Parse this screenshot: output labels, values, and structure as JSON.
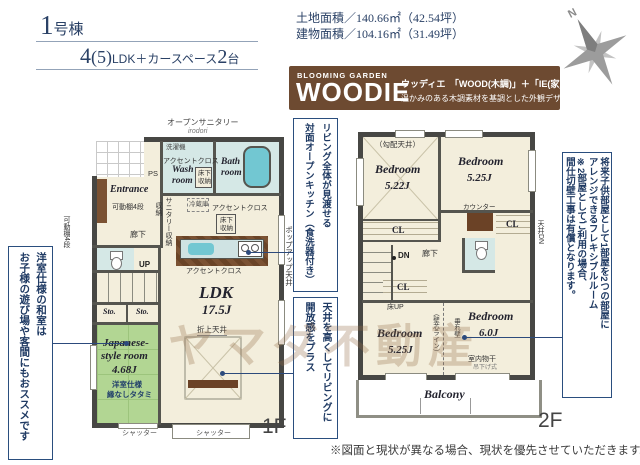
{
  "header": {
    "building_num": "1",
    "building_suffix": "号棟",
    "plan_main": "4",
    "plan_paren": "(5)",
    "plan_mid": "LDK＋カースペース",
    "plan_count": "2",
    "plan_count_unit": "台",
    "land_area": "土地面積／140.66㎡（42.54坪）",
    "building_area": "建物面積／104.16㎡（31.49坪）"
  },
  "brand": {
    "series": "BLOOMING GARDEN",
    "name": "WOODIE",
    "tagline1": "ウッディエ　「WOOD(木調)」＋「IE(家)」",
    "tagline2": "温かみのある木調素材を基調とした外観デザイン",
    "bg_color": "#6d4a31"
  },
  "compass": {
    "north": "N"
  },
  "notes": {
    "left_col1": "洋室仕様の和室は",
    "left_col2": "お子様の遊び場や客間にもおススメです",
    "mid1_col1": "リビング全体が見渡せる",
    "mid1_col2": "対面オープンキッチン（食洗器付き）",
    "mid2_col1": "天井を高くしてリビングに",
    "mid2_col2": "開放感をプラス",
    "right_col1": "将来子供部屋として1部屋を2つの部屋に",
    "right_col2": "アレンジできるフレキシブルルーム",
    "right_col3": "※2部屋としてご利用の場合、",
    "right_col4": "間仕切壁工事は有償となります。",
    "bottom": "※図面と現状が異なる場合、現状を優先させていただきます。"
  },
  "watermark": "ヤマダ不動産",
  "floor1": {
    "label": "1F",
    "open_sanitary": "オープンサニタリー",
    "open_sanitary_sub": "irodori",
    "washer": "洗濯機",
    "accent_cross": "アクセントクロス",
    "ps": "PS",
    "wash_room_1": "Wash",
    "wash_room_2": "room",
    "underfloor_1": "床下",
    "underfloor_2": "収納",
    "bath_room_1": "Bath",
    "bath_room_2": "room",
    "entrance": "Entrance",
    "shelf4": "可動棚4段",
    "sanitary_storage": "サニタリー収納",
    "storage": "収納",
    "fridge": "冷蔵庫",
    "popup_ceiling": "ポップアップ天井",
    "hallway": "廊下",
    "up": "UP",
    "sto": "Sto.",
    "ldk": "LDK",
    "ldk_size": "17.5J",
    "coffered": "折上天井",
    "jp_room_1": "Japanese-",
    "jp_room_2": "style room",
    "jp_size": "4.68J",
    "jp_note1": "洋室仕様",
    "jp_note2": "縁なしタタミ",
    "shutter": "シャッター"
  },
  "floor2": {
    "label": "2F",
    "sloped": "（勾配天井）",
    "bedroom": "Bedroom",
    "bed1_size": "5.22J",
    "bed2_size": "5.25J",
    "bed3_size": "5.25J",
    "bed4_size": "6.0J",
    "counter": "カウンター",
    "cl": "CL",
    "ceiling_dn": "天井DN",
    "dn": "DN",
    "hallway": "廊下",
    "floor_up": "床UP",
    "wall_core": "（壁芯ライン）",
    "hanging_wall": "垂れ壁",
    "indoor_drying": "室内物干",
    "hanging_type": "吊下げ式",
    "balcony": "Balcony"
  },
  "colors": {
    "accent_navy": "#1f3a63",
    "wall": "#474744",
    "room_cream": "#f3eedc",
    "wet_blue": "#d5e8e6",
    "tatami_green": "#b2d693",
    "tub_cyan": "#72c7d2",
    "counter_brown": "#7b5233",
    "brand_brown": "#6d4a31"
  }
}
